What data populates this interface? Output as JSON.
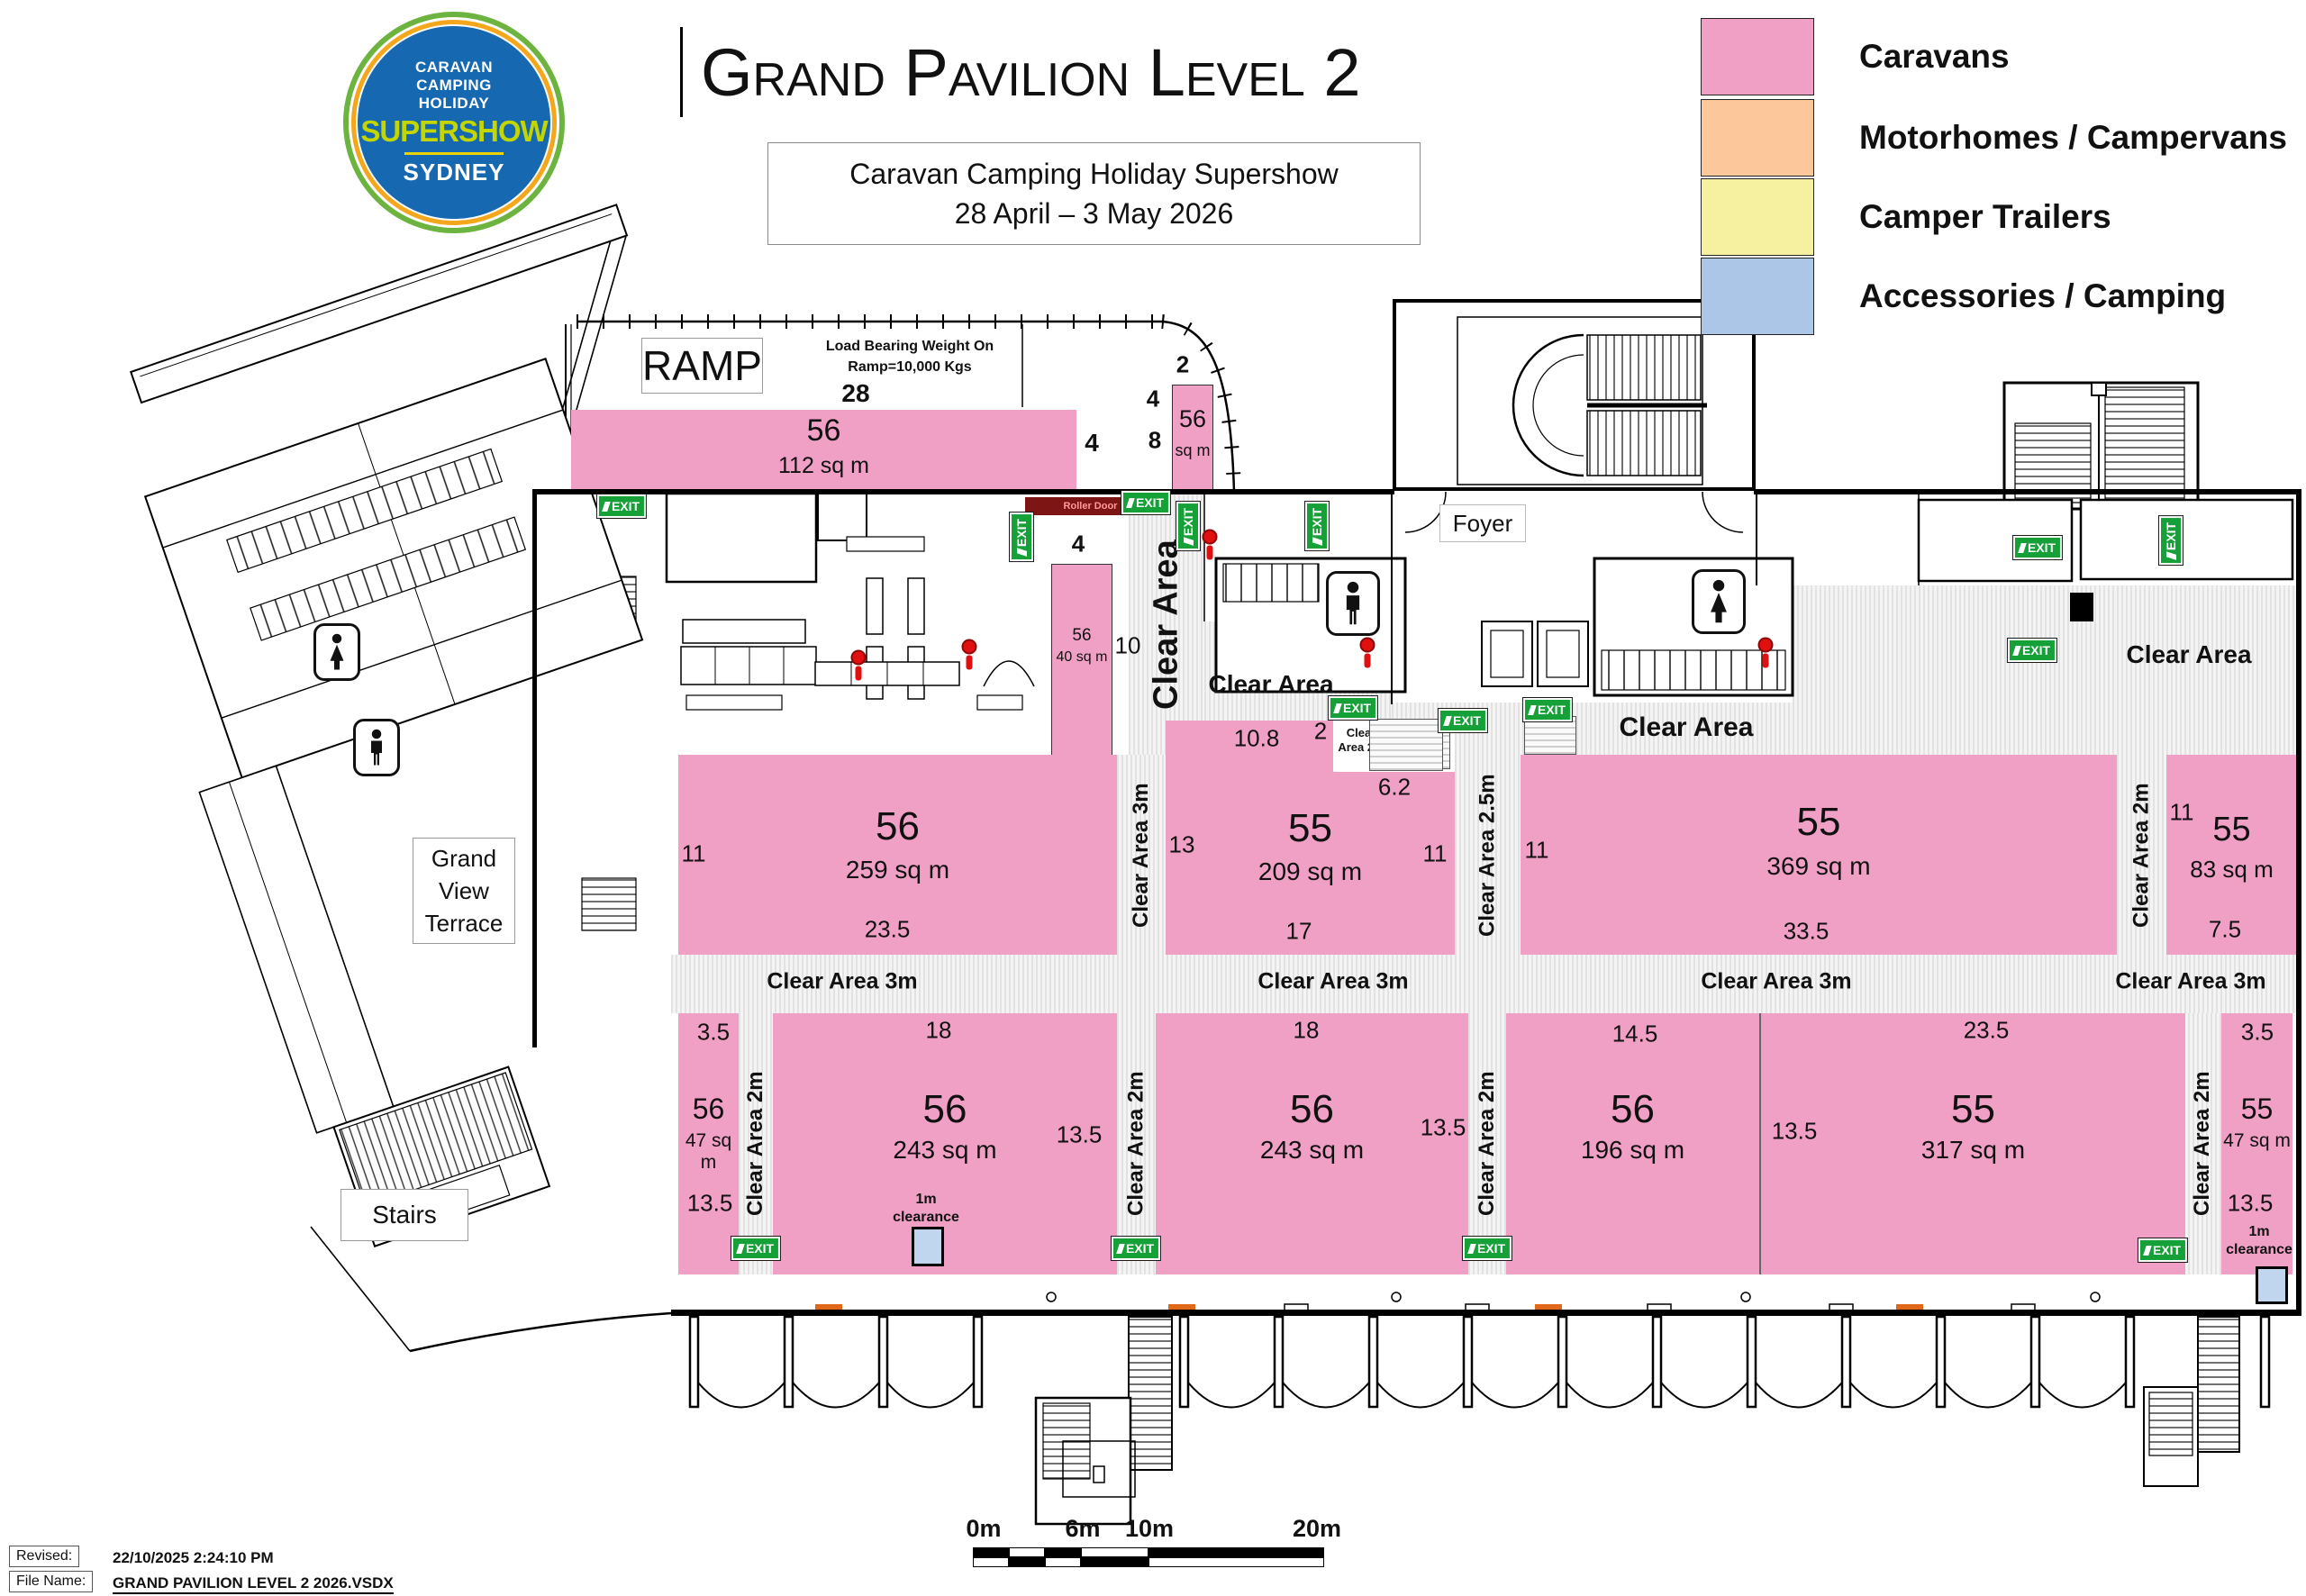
{
  "header": {
    "logo": {
      "line1": "CARAVAN",
      "line2": "CAMPING",
      "line3": "HOLIDAY",
      "brand": "SUPERSHOW",
      "city": "SYDNEY"
    },
    "title": "Grand Pavilion Level 2",
    "subtitle_line1": "Caravan Camping Holiday Supershow",
    "subtitle_line2": "28 April – 3 May 2026"
  },
  "legend": {
    "items": [
      {
        "label": "Caravans",
        "color": "#F1A0C5"
      },
      {
        "label": "Motorhomes / Campervans",
        "color": "#FBC79B"
      },
      {
        "label": "Camper Trailers",
        "color": "#F5F1A0"
      },
      {
        "label": "Accessories / Camping",
        "color": "#ABC6E6"
      }
    ]
  },
  "plan": {
    "ramp_label": "RAMP",
    "load_bearing_line1": "Load Bearing Weight On",
    "load_bearing_line2": "Ramp=10,000 Kgs",
    "roller_door": "Roller Door",
    "foyer": "Foyer",
    "terrace_line1": "Grand",
    "terrace_line2": "View",
    "terrace_line3": "Terrace",
    "stairs": "Stairs",
    "exit_label": "EXIT",
    "clear_area": "Clear Area",
    "clear_area_3m": "Clear Area 3m",
    "clear_area_2m": "Clear Area 2m",
    "clear_area_2_5m": "Clear Area 2.5m",
    "clearance_line1": "1m",
    "clearance_line2": "clearance",
    "blocks": [
      {
        "booth": "56",
        "area": "112 sq m",
        "dims": {
          "top": "28",
          "right": "4"
        }
      },
      {
        "booth": "56",
        "area": "sq m",
        "dims": {
          "top": "2",
          "left1": "4",
          "left2": "8"
        }
      },
      {
        "booth": "56",
        "area": "40 sq m",
        "dims": {
          "top": "4",
          "right": "10"
        }
      },
      {
        "booth": "56",
        "area": "259 sq m",
        "dims": {
          "left": "11",
          "bottom": "23.5"
        }
      },
      {
        "booth": "55",
        "area": "209 sq m",
        "dims": {
          "top": "10.8",
          "left": "13",
          "right": "11",
          "bottom": "17",
          "notch_h": "2",
          "notch_w": "6.2"
        }
      },
      {
        "booth": "55",
        "area": "369 sq m",
        "dims": {
          "left": "11",
          "bottom": "33.5"
        }
      },
      {
        "booth": "55",
        "area": "83 sq m",
        "dims": {
          "left": "11",
          "bottom": "7.5"
        }
      },
      {
        "booth": "56",
        "area": "47 sq m",
        "dims": {
          "top": "3.5",
          "bottom": "13.5"
        }
      },
      {
        "booth": "56",
        "area": "243 sq m",
        "dims": {
          "top": "18",
          "right": "13.5"
        }
      },
      {
        "booth": "56",
        "area": "243 sq m",
        "dims": {
          "top": "18",
          "right": "13.5"
        }
      },
      {
        "booth": "56",
        "area": "196 sq m",
        "dims": {
          "top": "14.5"
        }
      },
      {
        "booth": "55",
        "area": "317 sq m",
        "dims": {
          "top": "23.5",
          "left": "13.5"
        }
      },
      {
        "booth": "55",
        "area": "47 sq m",
        "dims": {
          "top": "3.5",
          "bottom": "13.5"
        }
      }
    ]
  },
  "scale_bar": {
    "labels": [
      "0m",
      "6m",
      "10m",
      "20m"
    ]
  },
  "footer": {
    "revised_label": "Revised:",
    "revised_value": "22/10/2025 2:24:10 PM",
    "file_label": "File Name:",
    "file_value": "GRAND PAVILION LEVEL 2 2026.VSDX"
  }
}
